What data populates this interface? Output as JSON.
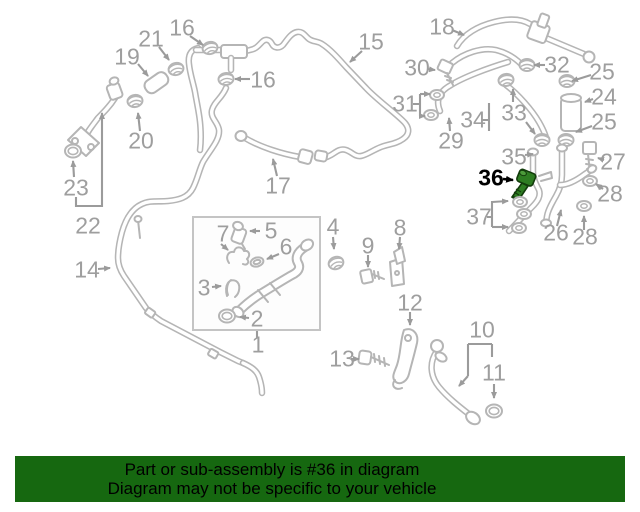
{
  "diagram": {
    "background": "#ffffff",
    "line_color": "#b5b5b5",
    "label_color": "#9e9e9e",
    "highlight": {
      "label": "36",
      "part": "green-bolt",
      "color": "#2e7d22",
      "outline": "#123c0b",
      "label_color": "#000000"
    },
    "callouts": [
      {
        "label": "1",
        "x": 258,
        "y": 345
      },
      {
        "label": "2",
        "x": 257,
        "y": 319
      },
      {
        "label": "3",
        "x": 204,
        "y": 288
      },
      {
        "label": "4",
        "x": 333,
        "y": 227
      },
      {
        "label": "5",
        "x": 271,
        "y": 231
      },
      {
        "label": "6",
        "x": 286,
        "y": 247
      },
      {
        "label": "7",
        "x": 223,
        "y": 234
      },
      {
        "label": "8",
        "x": 400,
        "y": 228
      },
      {
        "label": "9",
        "x": 368,
        "y": 246
      },
      {
        "label": "10",
        "x": 482,
        "y": 330
      },
      {
        "label": "11",
        "x": 494,
        "y": 373
      },
      {
        "label": "12",
        "x": 410,
        "y": 303
      },
      {
        "label": "13",
        "x": 342,
        "y": 359
      },
      {
        "label": "14",
        "x": 87,
        "y": 270
      },
      {
        "label": "15",
        "x": 371,
        "y": 42
      },
      {
        "label": "16",
        "x": 182,
        "y": 28
      },
      {
        "label": "16",
        "x": 263,
        "y": 80
      },
      {
        "label": "17",
        "x": 278,
        "y": 186
      },
      {
        "label": "18",
        "x": 442,
        "y": 27
      },
      {
        "label": "19",
        "x": 127,
        "y": 57
      },
      {
        "label": "20",
        "x": 141,
        "y": 141
      },
      {
        "label": "21",
        "x": 151,
        "y": 39
      },
      {
        "label": "22",
        "x": 88,
        "y": 226
      },
      {
        "label": "23",
        "x": 76,
        "y": 188
      },
      {
        "label": "24",
        "x": 604,
        "y": 97
      },
      {
        "label": "25",
        "x": 602,
        "y": 72
      },
      {
        "label": "25",
        "x": 604,
        "y": 122
      },
      {
        "label": "26",
        "x": 556,
        "y": 233
      },
      {
        "label": "27",
        "x": 613,
        "y": 162
      },
      {
        "label": "28",
        "x": 610,
        "y": 194
      },
      {
        "label": "28",
        "x": 585,
        "y": 237
      },
      {
        "label": "29",
        "x": 451,
        "y": 141
      },
      {
        "label": "30",
        "x": 417,
        "y": 68
      },
      {
        "label": "31",
        "x": 405,
        "y": 104
      },
      {
        "label": "32",
        "x": 557,
        "y": 65
      },
      {
        "label": "33",
        "x": 514,
        "y": 113
      },
      {
        "label": "34",
        "x": 473,
        "y": 120
      },
      {
        "label": "35",
        "x": 514,
        "y": 157
      },
      {
        "label": "36",
        "x": 491,
        "y": 178,
        "emphasis": true
      },
      {
        "label": "37",
        "x": 479,
        "y": 217
      }
    ]
  },
  "banner": {
    "line1": "Part or sub-assembly is #36 in diagram",
    "line2": "Diagram may not be specific to your vehicle",
    "background": "#166810",
    "text_color": "#000000"
  }
}
